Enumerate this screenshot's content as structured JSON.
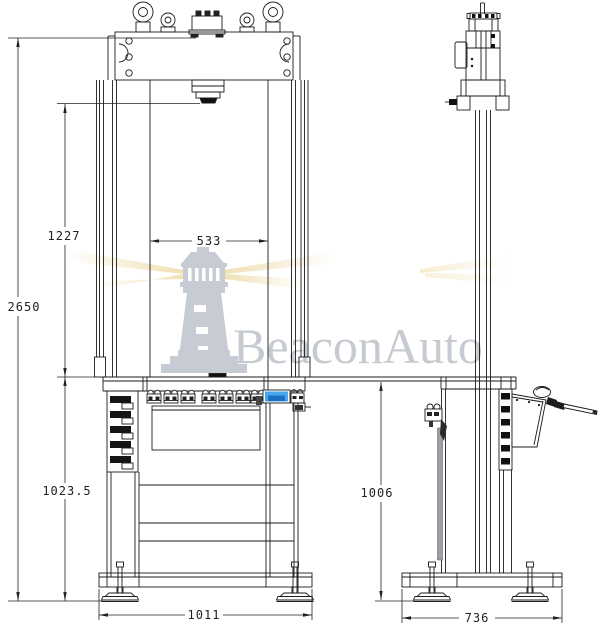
{
  "watermark": {
    "brand": "BeaconAuto",
    "logo": "lighthouse-icon",
    "text_color": "#c6cbd2",
    "logo_color": "#c7ccd4",
    "beam_color": "#eeddaa"
  },
  "views": {
    "front": {
      "dimensions": {
        "overall_height": "2650",
        "clearance_height": "1227",
        "column_span": "533",
        "table_height": "1023.5",
        "base_width": "1011"
      }
    },
    "side": {
      "dimensions": {
        "table_height": "1006",
        "base_depth": "736"
      }
    }
  },
  "colors": {
    "line": "#1b1b1b",
    "display_blue": "#49a8ea",
    "display_blue_dark": "#1d6fc4",
    "panel_gray": "#9aa0a6"
  }
}
